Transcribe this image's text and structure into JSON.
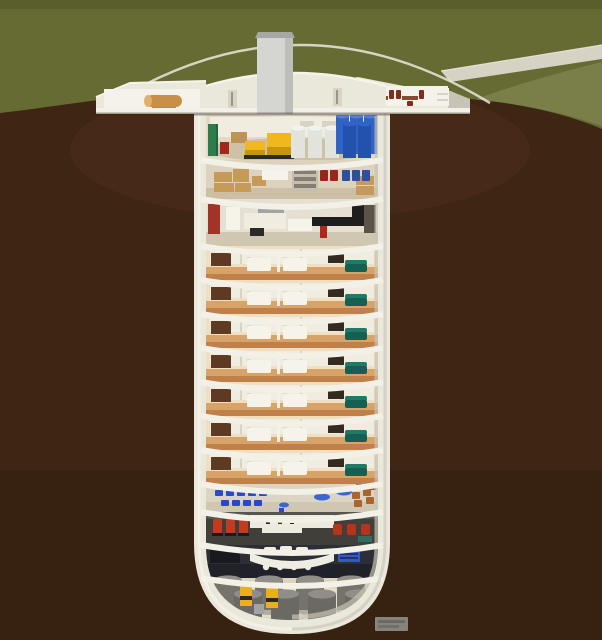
{
  "scene": {
    "subject": "cutaway-illustration-of-underground-survival-silo",
    "view": "cross-section",
    "surface": "grass field with access road and domed entrance building",
    "underground": "15-level cylindrical bunker in earth"
  },
  "palette": {
    "grassTop": "#575D2B",
    "grass": "#666B33",
    "grassLight": "#7A7E49",
    "road": "#D6D3C4",
    "roadEdge": "#E9E6DA",
    "earth": "#3E2514",
    "earthLight": "#4F301B",
    "earthDark": "#2E1B0D",
    "glass": "#E9E7DB",
    "shell": "#EAE7DB",
    "shellShadow": "#C7C4B5",
    "shellHi": "#F6F3E9",
    "slab": "#F2F0E7",
    "cavity": "#D9D0BC",
    "tower": "#D5D6D2",
    "towerTop": "#A6A8A5",
    "towerShade": "#BDBFBA",
    "wallWhite": "#F4F2EA",
    "interiorWall": "#F0ECE0",
    "vent": "#D8D3C2",
    "doorSlit": "#9A958A",
    "mechBg": "#E3DAC6",
    "mechFloor": "#CFC1A6",
    "greenCab": "#2E7C4B",
    "greenDark": "#236242",
    "redBox": "#A1271A",
    "pallet": "#BE9455",
    "yellow": "#EFB91D",
    "yellowDark": "#C9940F",
    "dark": "#2A2A26",
    "silver": "#E3E3DE",
    "silverTop": "#F1F1ED",
    "blueTank": "#2F63C5",
    "blueTankDark": "#2252AE",
    "blueTankTop": "#5580D8",
    "storBg": "#DCD2BD",
    "storFloor": "#CDBFA4",
    "crate": "#C69A58",
    "crateDark": "#A87C3E",
    "shelfGray": "#C5BFB0",
    "drumRed": "#96271A",
    "drumBlue": "#2C4FA0",
    "kitFloor": "#E6E0D3",
    "kitWall": "#A33326",
    "kitBlack": "#1E1E1C",
    "appliance": "#A2A3A5",
    "darkShelf": "#5C5348",
    "redItem": "#B2271C",
    "resWall": "#EDE2CC",
    "resFloor": "#D8A369",
    "resFloorDark": "#C08049",
    "resWood": "#5F3A22",
    "resDark": "#352A1F",
    "resWhite": "#F6F3EB",
    "headboard": "#E0D9C9",
    "teal": "#1F7A68",
    "tealDark": "#156052",
    "glow": "#F4C87B",
    "classBlue": "#2B49C6",
    "classBlue2": "#3A66D4",
    "libBrown": "#A9642F",
    "shelfBrown": "#8A5A2E",
    "classFloor": "#DCD4C2",
    "classFloorFront": "#CFC7B2",
    "gymBg": "#575550",
    "gymFloor": "#413F3A",
    "gymWall": "#EDEAE0",
    "gymRed": "#C23B1F",
    "chairRed": "#B5341C",
    "gymTeal": "#2E6E62",
    "barBg": "#2D2E36",
    "barFloor": "#212229",
    "barWhite": "#EFECE2",
    "screenBlue": "#3558C8",
    "barDark": "#191A20",
    "tankBg": "#DCD3BD",
    "tankFloor": "#E6DEC8",
    "grayTank": "#75736C",
    "grayTankTop": "#908E87",
    "grayTankFront": "#6B6963",
    "pump": "#E9B01C",
    "log": "#C98F47",
    "logEnd": "#E0B06A",
    "logBase": "#C77F35",
    "tableBrown": "#8A4A2E",
    "chairBrown": "#7E2F1F",
    "shadowLine": "#2F1D10",
    "wmBg": "#8C8C85",
    "wmText": "#63635C"
  },
  "counts": {
    "residential_floors": 7,
    "classroom_desks": [
      5,
      4
    ],
    "water_tanks_back": 4,
    "water_tanks_front": 4,
    "blue_tanks_back": 3,
    "blue_tanks_front": 2,
    "fuel_tanks": 3,
    "generators": 2,
    "bar_stools": 4,
    "gym_machines": 3,
    "gym_chairs": 3,
    "red_drums": 2,
    "blue_drums": 3,
    "dining_tables": 2
  },
  "levels": [
    {
      "name": "surface-entrance-dome",
      "items": [
        "entrance-tower",
        "storage-wing-with-log",
        "dining-wing-tables",
        "access-road",
        "glass-canopy"
      ]
    },
    {
      "name": "mechanical-plant",
      "items": [
        {
          "item": "electrical-cabinet",
          "color": "#2E7C4B"
        },
        {
          "item": "generators",
          "color": "#EFB91D"
        },
        {
          "item": "fuel-tanks",
          "color": "#E3E3DE"
        },
        {
          "item": "water-tanks",
          "color": "#2F63C5"
        }
      ]
    },
    {
      "name": "dry-goods-storage",
      "items": [
        {
          "item": "supply-crates",
          "color": "#C69A58"
        },
        {
          "item": "shelving",
          "color": "#C5BFB0"
        },
        {
          "item": "red-drums",
          "color": "#96271A"
        },
        {
          "item": "blue-drums",
          "color": "#2C4FA0"
        }
      ]
    },
    {
      "name": "kitchen-common-area",
      "items": [
        {
          "item": "red-feature-wall",
          "color": "#A33326"
        },
        {
          "item": "white-cabinetry",
          "color": "#F0ECE0"
        },
        {
          "item": "black-counters",
          "color": "#1E1E1C"
        }
      ]
    },
    {
      "name": "residential-condo-floors",
      "count": 7,
      "items": [
        {
          "item": "wardrobe",
          "color": "#5F3A22"
        },
        {
          "item": "beds",
          "color": "#F6F3EB"
        },
        {
          "item": "media-wall",
          "color": "#352A1F"
        },
        {
          "item": "sofa",
          "color": "#1F7A68"
        },
        {
          "item": "terracotta-floor",
          "color": "#D8A369"
        }
      ]
    },
    {
      "name": "classroom-library",
      "items": [
        {
          "item": "student-desks",
          "color": "#2B49C6"
        },
        {
          "item": "round-tables",
          "color": "#3A66D4"
        },
        {
          "item": "reading-chairs",
          "color": "#A9642F"
        },
        {
          "item": "bookshelf",
          "color": "#8A5A2E"
        }
      ]
    },
    {
      "name": "gym-and-workstations",
      "items": [
        {
          "item": "exercise-machines",
          "color": "#C23B1F"
        },
        {
          "item": "desks",
          "color": "#EDEAE0"
        },
        {
          "item": "task-chairs",
          "color": "#B5341C"
        }
      ]
    },
    {
      "name": "lounge-media-bar",
      "items": [
        {
          "item": "curved-bar",
          "color": "#EFECE2"
        },
        {
          "item": "stools",
          "color": "#EFECE2"
        },
        {
          "item": "media-screens",
          "color": "#3558C8"
        }
      ]
    },
    {
      "name": "water-storage-pump-room",
      "items": [
        {
          "item": "storage-tanks",
          "color": "#75736C"
        },
        {
          "item": "pumps",
          "color": "#E9B01C"
        }
      ]
    }
  ],
  "watermark": {
    "present": true,
    "legible": false
  }
}
